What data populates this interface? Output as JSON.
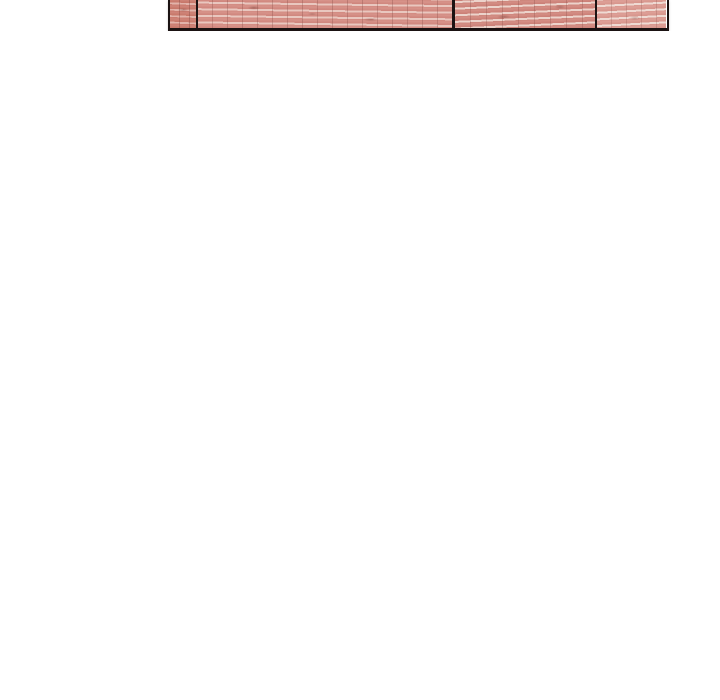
{
  "page": {
    "background_color": "#ffffff"
  },
  "comic_panel": {
    "alt_text": "Bottom sliver of a comic panel showing a red brick wall with black outline and vertical structural lines",
    "border_color": "#1a1212",
    "divider_color": "#1c1313",
    "sections": [
      {
        "name": "left-pillar",
        "brick_color": "#cb7d74",
        "mortar_color": "#e2b3aa"
      },
      {
        "name": "wall-main",
        "brick_color": "#d48d84",
        "mortar_color": "#e9c7bf"
      },
      {
        "name": "wall-mid-right",
        "brick_color": "#cf857c",
        "mortar_color": "#ecd3cb"
      },
      {
        "name": "wall-right",
        "brick_color": "#db9a91",
        "mortar_color": "#efdad3"
      }
    ]
  }
}
